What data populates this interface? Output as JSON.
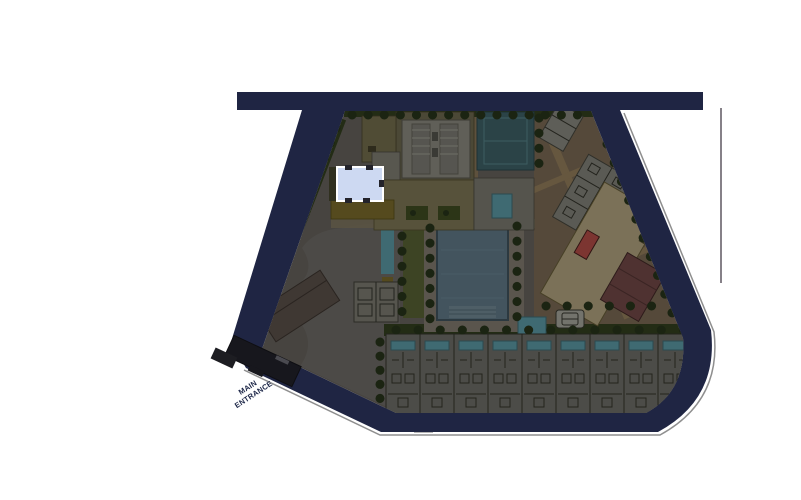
{
  "site_plan": {
    "labels": {
      "main_entrance_line1": "MAIN",
      "main_entrance_line2": "ENTRANCE"
    },
    "highlighted_building": {
      "state": "highlighted",
      "fill": "#cdd9f2",
      "border": "#ffffff"
    },
    "villa_units_count": 9,
    "colors": {
      "road": "#1f2543",
      "curb": "#8f8f8f",
      "base": "#474440",
      "drive": "#4c4a47",
      "hedge": "#232c15",
      "tree": "#1b2412",
      "lawn": "#3d4424",
      "pool": "#43545e",
      "poolsmall": "#3f6a72",
      "court": "#2b4347",
      "olive": "#4b4836",
      "olive2": "#57523b",
      "gray1": "#605f58",
      "gray2": "#55544d",
      "beige": "#7b7158",
      "maroon": "#4f3231",
      "red": "#7c3531",
      "brown": "#3f3833",
      "ramp": "#17171d",
      "units": "#4c4c48",
      "line": "#23231d",
      "tan": "#55493a",
      "walk": "#66573f",
      "mustard": "#554a1e",
      "hl": "#cdd9f2",
      "hlBorder": "#ffffff",
      "label": "#1b2547"
    }
  }
}
